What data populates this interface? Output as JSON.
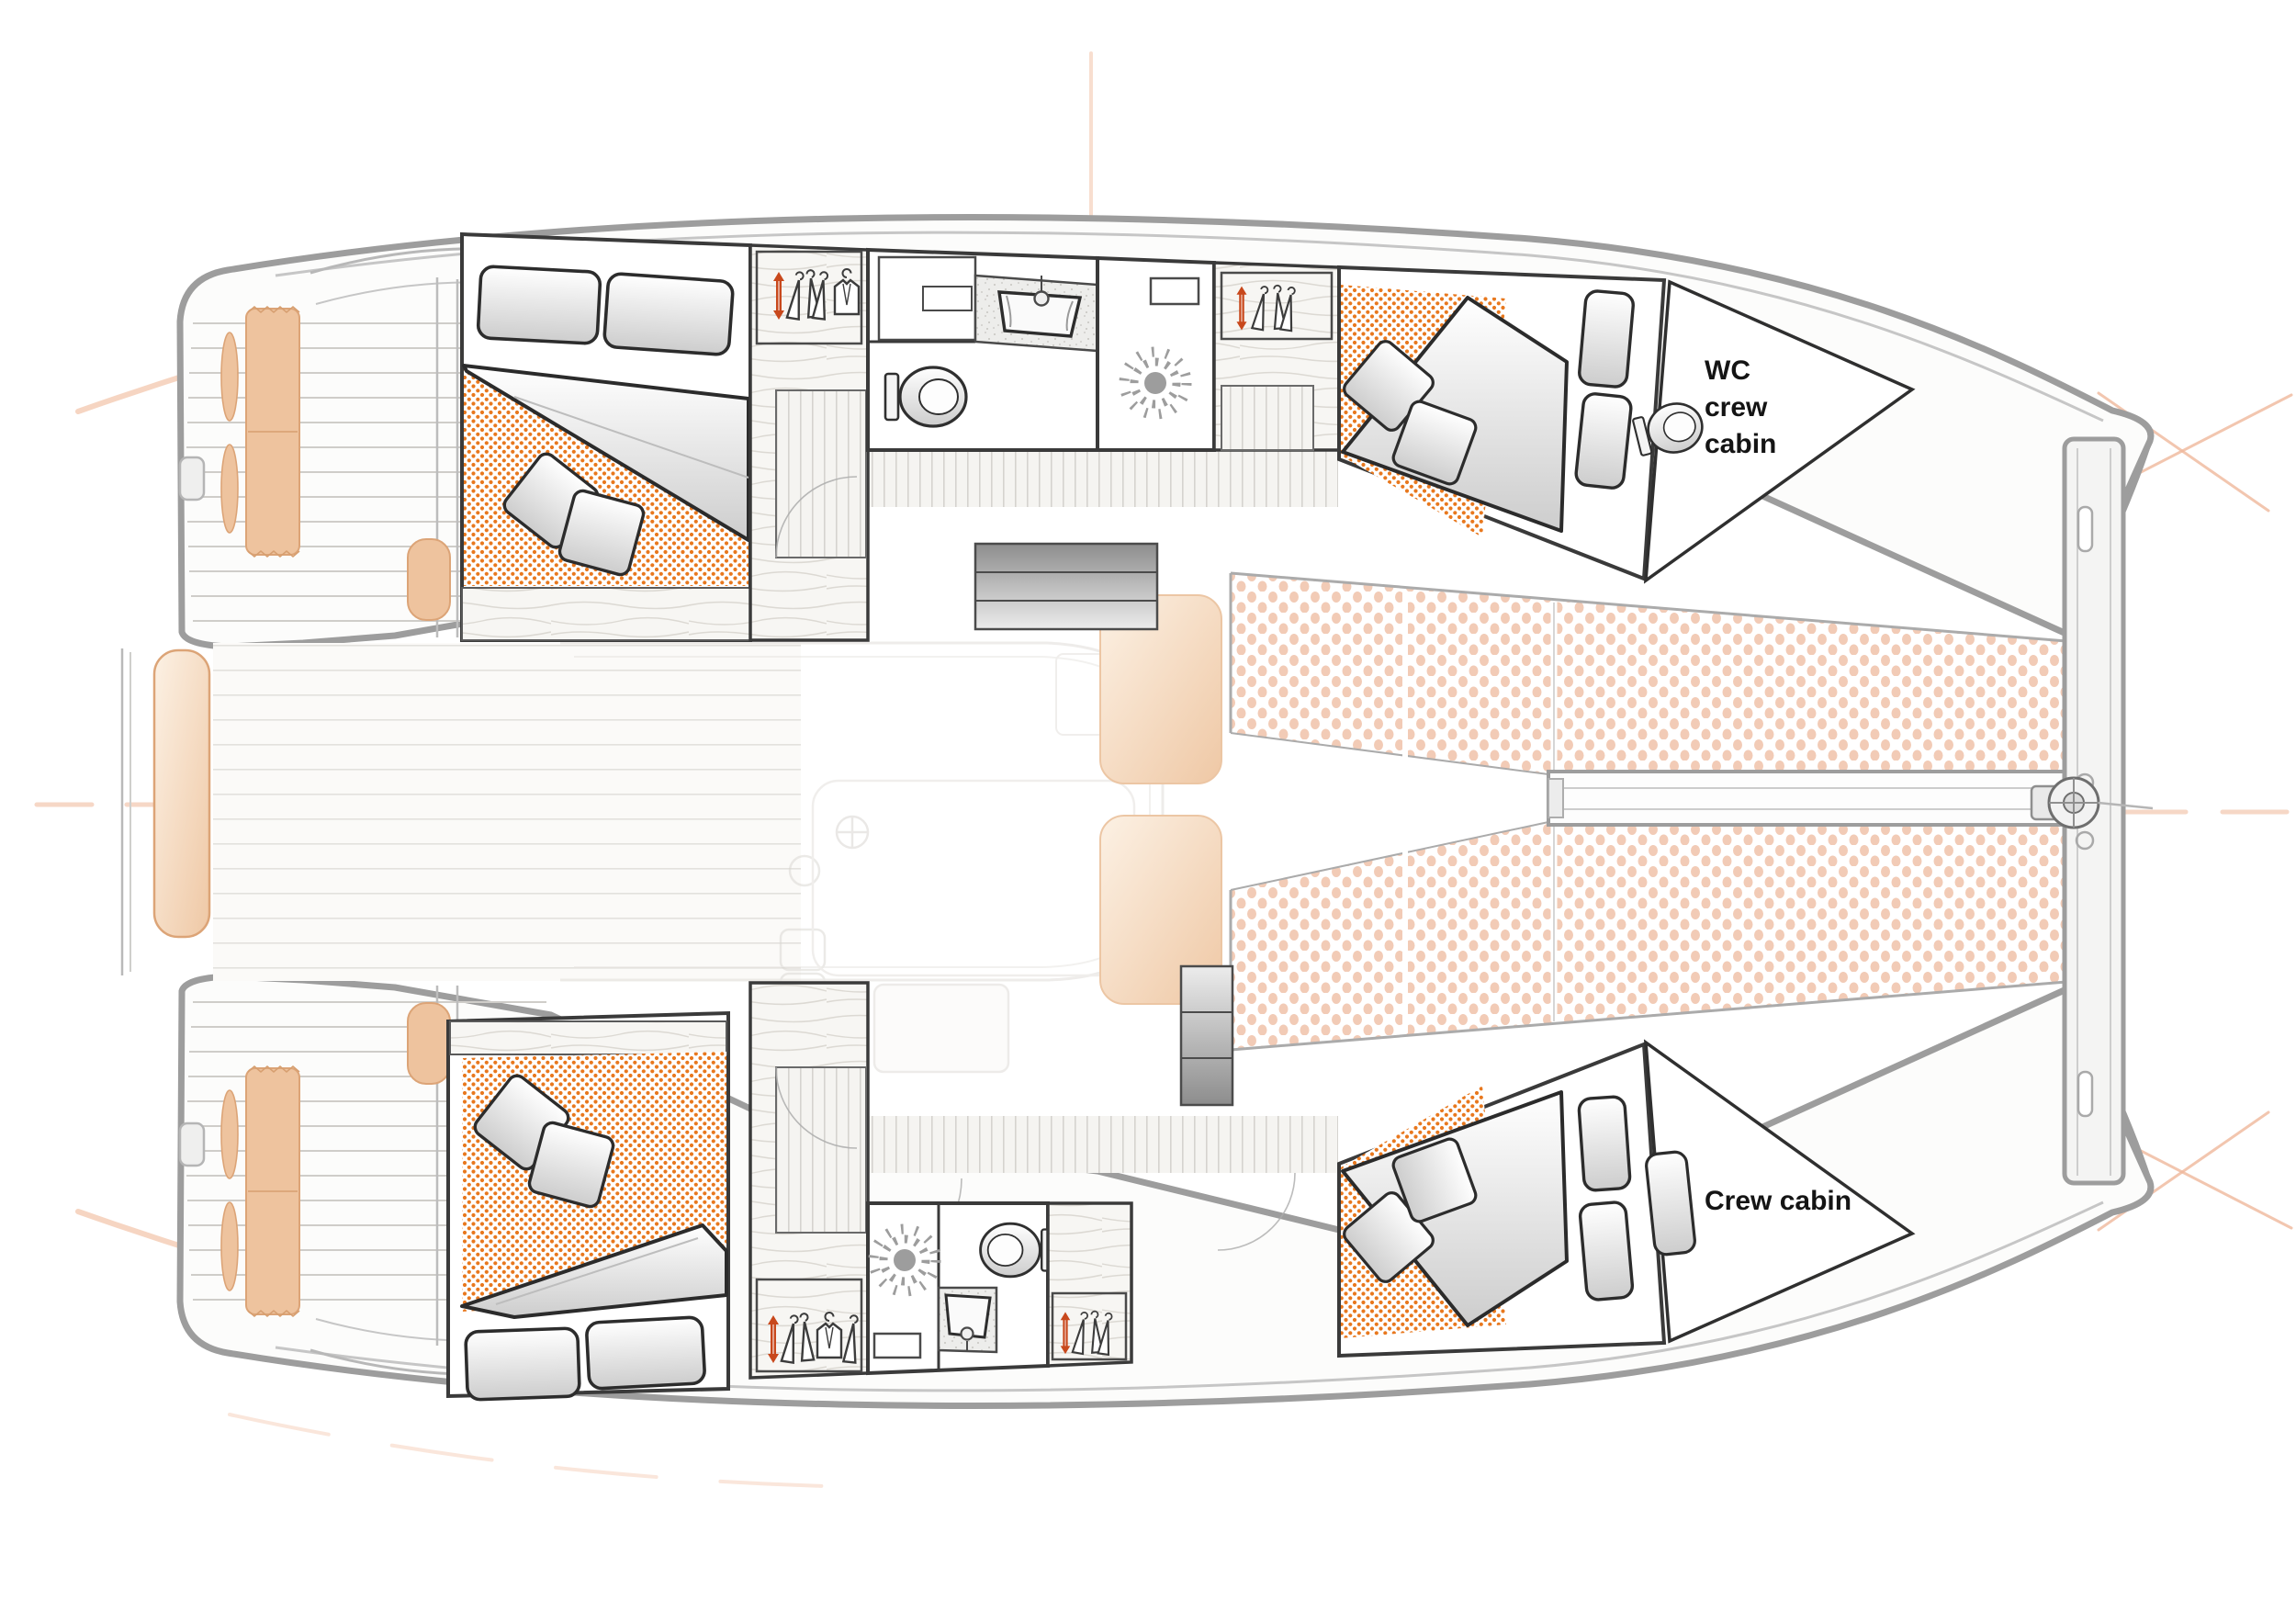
{
  "app": {
    "type": "catamaran-deck-plan",
    "background": "#ffffff"
  },
  "labels": {
    "wc_crew_cabin": "WC crew cabin",
    "crew_cabin": "Crew cabin"
  },
  "colors": {
    "hull_outline": "#9d9d9d",
    "deck_line": "#c6c6c6",
    "room_wall": "#3a3a3a",
    "mattress_dots": "#e8781e",
    "trampoline_dots": "#f2cbb6",
    "cushion_tan": "#eec39e",
    "cushion_tan_edge": "#dca477",
    "hanger_accent_red": "#c8481c",
    "wood_line": "#d8d5d0",
    "plank_line": "#d5d3cf",
    "ghost_gray": "#dedbd6",
    "guide_peach": "#f3c7ae",
    "label_text": "#141414"
  },
  "icons": {
    "toilet-icon": "oval bowl with cistern",
    "shower-drain-icon": "sunburst drain",
    "sink-icon": "trapezoid basin",
    "pendant-lamp-icon": "cord with bulb",
    "hanger-icon": "clothes hanger",
    "hanger-accent-icon": "red clothes hanger",
    "garment-icon": "hanging garment",
    "stairs-icon": "gradient steps",
    "windlass-icon": "anchor windlass disc",
    "pillow-icon": "bed pillow",
    "duvet-icon": "folded duvet wedge",
    "sun-pad-icon": "tan deck cushion",
    "trampoline-icon": "netting dots",
    "crosshair-icon": "peach centerline guides"
  }
}
